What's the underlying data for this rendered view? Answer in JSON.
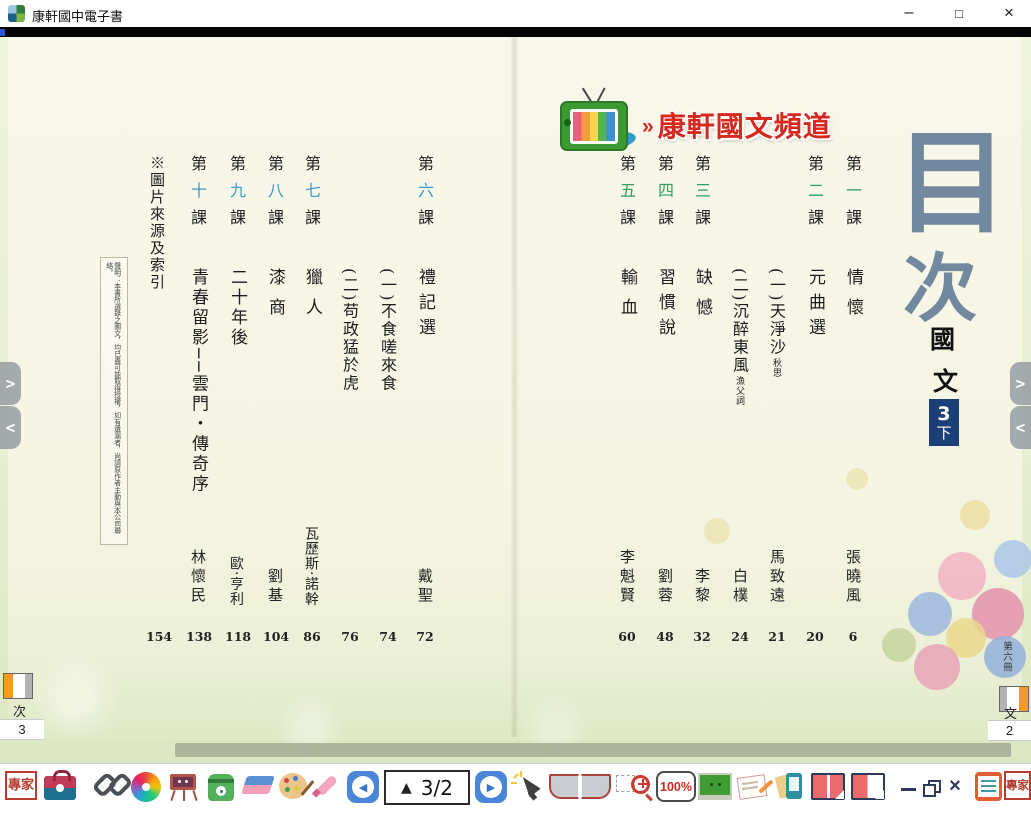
{
  "window": {
    "title": "康軒國中電子書",
    "minimize": "–",
    "maximize": "□",
    "close": "×"
  },
  "banner": {
    "chevron": "»",
    "label": "康軒國文頻道"
  },
  "cover": {
    "toc_top": "目",
    "toc_bottom": "次",
    "subject_top": "國",
    "subject_bottom": "文",
    "volume_num": "3",
    "volume_suffix": "下"
  },
  "toc": {
    "ordinal_prefix": "第",
    "ordinal_suffix": "課",
    "right": [
      {
        "num": "一",
        "title": "情懷",
        "note": "",
        "author": "張曉風",
        "page": "6"
      },
      {
        "num": "二",
        "title": "元曲選",
        "note": "",
        "author": "",
        "page": "20"
      },
      {
        "num": "",
        "title": "(一)天淨沙",
        "note": "秋思",
        "author": "馬致遠",
        "page": "21"
      },
      {
        "num": "",
        "title": "(二)沉醉東風",
        "note": "漁父詞",
        "author": "白樸",
        "page": "24"
      },
      {
        "num": "三",
        "title": "缺憾",
        "note": "",
        "author": "李黎",
        "page": "32"
      },
      {
        "num": "四",
        "title": "習慣說",
        "note": "",
        "author": "劉蓉",
        "page": "48"
      },
      {
        "num": "五",
        "title": "輸血",
        "note": "",
        "author": "李魁賢",
        "page": "60"
      }
    ],
    "left": [
      {
        "num": "六",
        "title": "禮記選",
        "note": "",
        "author": "戴聖",
        "page": "72"
      },
      {
        "num": "",
        "title": "(一)不食嗟來食",
        "note": "",
        "author": "",
        "page": "74"
      },
      {
        "num": "",
        "title": "(二)苟政猛於虎",
        "note": "",
        "author": "",
        "page": "76"
      },
      {
        "num": "七",
        "title": "獵人",
        "note": "",
        "author": "瓦歷斯·諾幹",
        "page": "86"
      },
      {
        "num": "八",
        "title": "漆商",
        "note": "",
        "author": "劉基",
        "page": "104"
      },
      {
        "num": "九",
        "title": "二十年後",
        "note": "",
        "author": "歐·亨利",
        "page": "118"
      },
      {
        "num": "十",
        "title": "青春留影──雲門・傳奇序",
        "note": "",
        "author": "林懷民",
        "page": "138"
      },
      {
        "num": "",
        "title": "※圖片來源及索引",
        "note": "",
        "author": "",
        "page": "154"
      }
    ],
    "note": "聲明：本書所選錄之圖文，均已盡可能取得授權，如有遺漏者，尚請原作者主動與本公司聯絡。"
  },
  "tabs": {
    "left_label": "次",
    "left_page": "3",
    "right_edge_label": "第六冊",
    "right_label": "文",
    "right_page": "2"
  },
  "nav": {
    "forward": ">",
    "backward": "<"
  },
  "toolbar": {
    "expert_left": "專家",
    "expert_right": "專家",
    "page_indicator": "3/2",
    "page_up_glyph": "▲",
    "prev_glyph": "◀",
    "next_glyph": "▶",
    "zoom_level": "100%",
    "window_close_glyph": "×"
  },
  "colors": {
    "left_lesson_num": "#3a9cc9",
    "right_lesson_num": "#2f9e60",
    "banner_red": "#d6281e",
    "volume_box_bg": "#1d3f77",
    "toc_title": "#72889f"
  }
}
